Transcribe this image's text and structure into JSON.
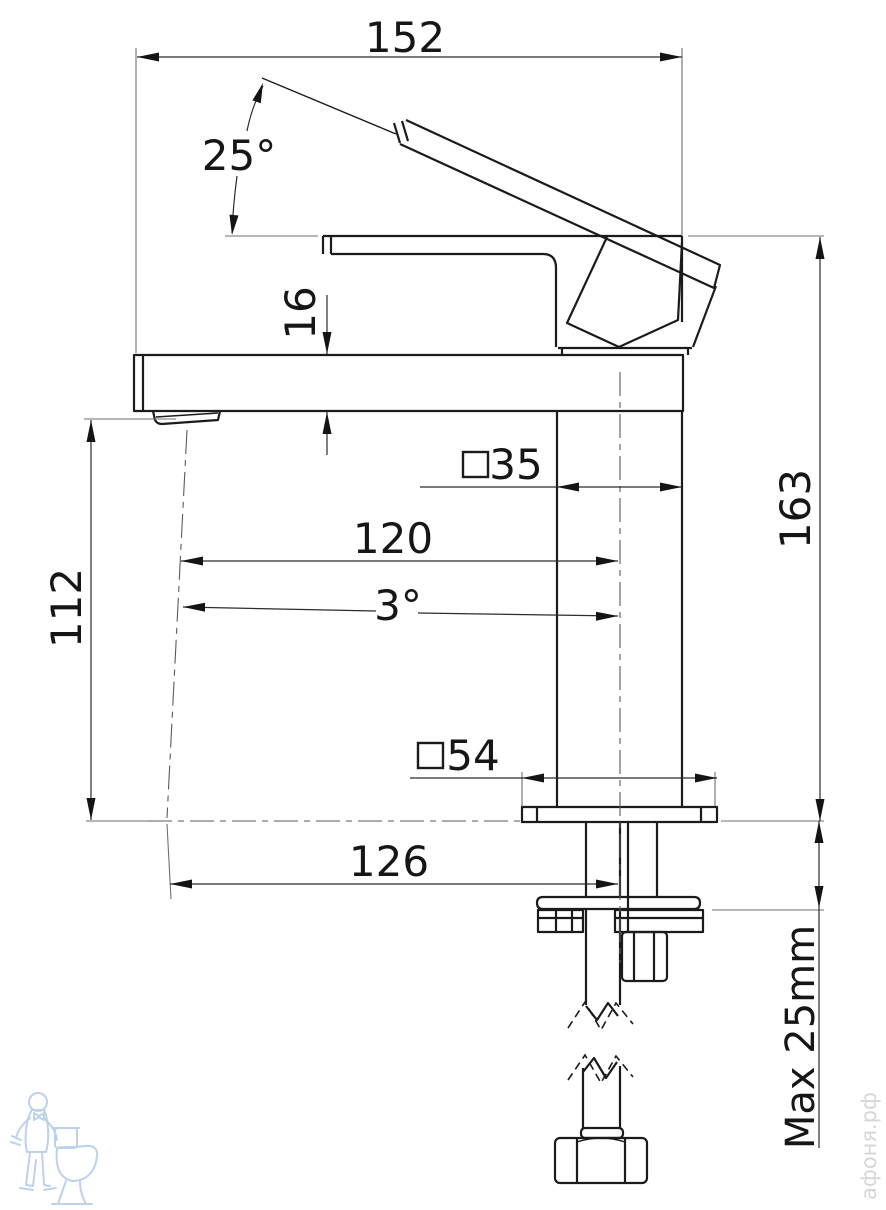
{
  "dims": {
    "top_width": "152",
    "handle_angle": "25°",
    "spout_thickness": "16",
    "body_square": "35",
    "spout_reach": "120",
    "spout_tilt": "3°",
    "outlet_height": "112",
    "overall_height": "163",
    "base_square": "54",
    "outlet_offset": "126",
    "max_counter_thickness": "Max 25mm"
  },
  "watermark": {
    "site": "афоня.рф",
    "logo": "plumber-with-toilet-logo"
  },
  "colors": {
    "outline": "#1b1b1b",
    "dimension": "#2b2b2b",
    "extension": "#6f6f6f",
    "watermark_text": "#d6d6d6",
    "watermark_logo": "#bcd2ea",
    "background": "#ffffff"
  }
}
